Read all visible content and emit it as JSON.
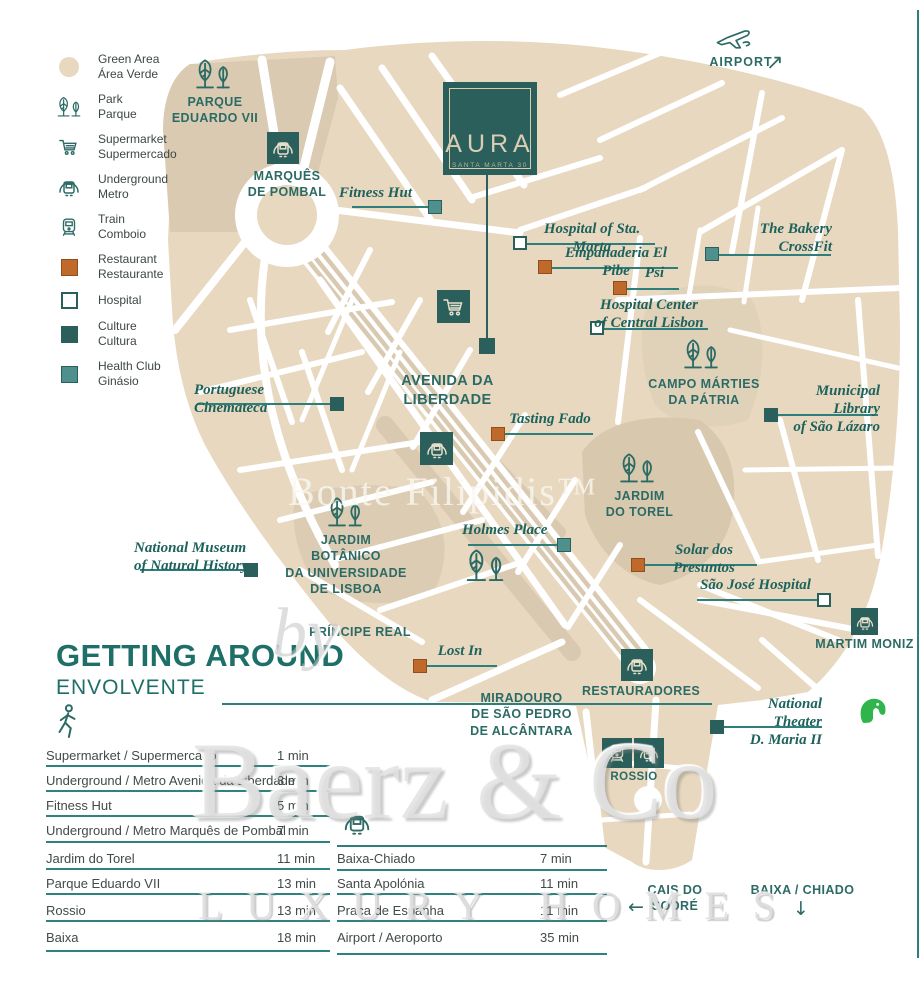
{
  "property": {
    "name": "AURA",
    "address": "SANTA MARTA 30"
  },
  "legend": {
    "items": [
      {
        "en": "Green Area",
        "pt": "Área Verde",
        "icon": "green-area-circle"
      },
      {
        "en": "Park",
        "pt": "Parque",
        "icon": "park-trees"
      },
      {
        "en": "Supermarket",
        "pt": "Supermercado",
        "icon": "shopping-cart"
      },
      {
        "en": "Underground",
        "pt": "Metro",
        "icon": "metro"
      },
      {
        "en": "Train",
        "pt": "Comboio",
        "icon": "train"
      },
      {
        "en": "Restaurant",
        "pt": "Restaurante",
        "icon": "orange-square"
      },
      {
        "en": "Hospital",
        "pt": "",
        "icon": "white-square"
      },
      {
        "en": "Culture",
        "pt": "Cultura",
        "icon": "dark-teal-square"
      },
      {
        "en": "Health Club",
        "pt": "Ginásio",
        "icon": "teal-square"
      }
    ]
  },
  "areas": [
    "PARQUE\nEDUARDO VII",
    "MARQUÊS\nDE POMBAL",
    "AVENIDA DA\nLIBERDADE",
    "CAMPO MÁRTIES\nDA PÁTRIA",
    "JARDIM\nDO TOREL",
    "JARDIM BOTÂNICO\nDA UNIVERSIDADE\nDE LISBOA",
    "PRÍNCIPE REAL",
    "MIRADOURO\nDE SÃO PEDRO\nDE ALCÂNTARA",
    "RESTAURADORES",
    "ROSSIO",
    "MARTIM MONIZ",
    "CAIS DO SODRÉ",
    "BAIXA / CHIADO",
    "AIRPORT"
  ],
  "pois": [
    {
      "name": "Fitness Hut",
      "type": "health-club"
    },
    {
      "name": "Hospital of Sta. Marta",
      "type": "hospital"
    },
    {
      "name": "Empanaderia El Pibe",
      "type": "restaurant"
    },
    {
      "name": "Psi",
      "type": "restaurant"
    },
    {
      "name": "The Bakery\nCrossFit",
      "type": "health-club"
    },
    {
      "name": "Hospital Center\nof  Central Lisbon",
      "type": "hospital"
    },
    {
      "name": "Portuguese Cinemateca",
      "type": "culture"
    },
    {
      "name": "Tasting Fado",
      "type": "restaurant"
    },
    {
      "name": "Municipal Library\nof São Lázaro",
      "type": "culture"
    },
    {
      "name": "Holmes Place",
      "type": "health-club"
    },
    {
      "name": "Solar dos Presuntos",
      "type": "restaurant"
    },
    {
      "name": "São José Hospital",
      "type": "hospital"
    },
    {
      "name": "National Museum\nof Natural History",
      "type": "culture"
    },
    {
      "name": "Lost In",
      "type": "restaurant"
    },
    {
      "name": "National Theater\nD. Maria II",
      "type": "culture"
    }
  ],
  "getting_around": {
    "title": "GETTING AROUND",
    "subtitle": "ENVOLVENTE",
    "walk": [
      {
        "label": "Supermarket / Supermercado",
        "time": "1 min"
      },
      {
        "label": "Underground / Metro Avenida da Liberdade",
        "time": "3 min"
      },
      {
        "label": "Fitness Hut",
        "time": "5 min"
      },
      {
        "label": "Underground / Metro Marquês de Pombal",
        "time": "7 min"
      },
      {
        "label": "Jardim do Torel",
        "time": "11 min"
      },
      {
        "label": "Parque Eduardo VII",
        "time": "13 min"
      },
      {
        "label": "Rossio",
        "time": "13 min"
      },
      {
        "label": "Baixa",
        "time": "18 min"
      }
    ],
    "transit": [
      {
        "label": "Baixa-Chiado",
        "time": "7 min"
      },
      {
        "label": "Santa Apolónia",
        "time": "11 min"
      },
      {
        "label": "Praça de Espanha",
        "time": "11 min"
      },
      {
        "label": "Airport / Aeroporto",
        "time": "35 min"
      }
    ]
  },
  "arrows": {
    "airport": "↗",
    "cais": "←",
    "baixa": "↓"
  },
  "watermarks": {
    "center": "Bonte Filipidis™",
    "by": "by",
    "brand": "Baerz & Co",
    "tagline": "LUXURY HOMES"
  },
  "colors": {
    "accent_dark_teal": "#2B5F5B",
    "health_teal": "#4E908E",
    "restaurant_orange": "#BF6A2A",
    "green_area_beige": "#E7D8BF",
    "label_teal": "#2C6B65"
  }
}
